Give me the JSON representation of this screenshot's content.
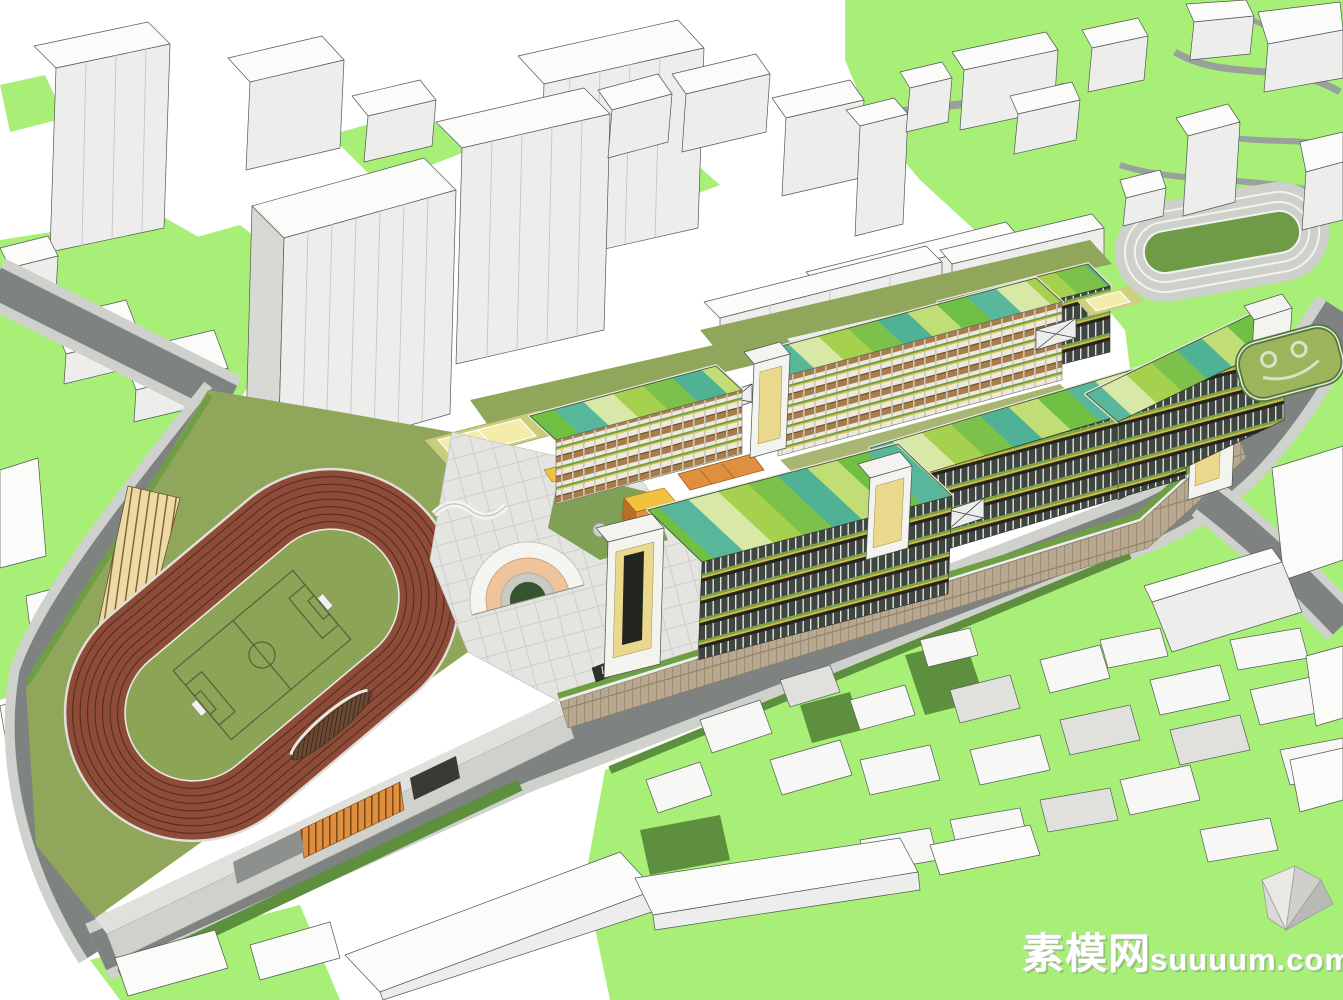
{
  "watermark": {
    "cn": "素模网",
    "en": "suuuum.com",
    "full": "素模网suuuum.com"
  },
  "colors": {
    "sky": "#ffffff",
    "ground_green": "#a7ef76",
    "campus_green": "#90a65a",
    "pitch_green": "#8ca455",
    "dark_green": "#5d8f3e",
    "hedge_green": "#6f9e45",
    "track_red": "#8d4b38",
    "track_line": "#4f2b20",
    "road_dark": "#7e8381",
    "sidewalk": "#d2d4d0",
    "wall_tan": "#b7a88f",
    "roof_teal": "#4fb295",
    "roof_lime": "#c0dd76",
    "roof_green": "#6fc043",
    "facade_dark": "#3f4540",
    "gallery_brown": "#a97d4b",
    "accent_orange": "#df8f3f",
    "accent_yellow": "#f0c23f",
    "stair_yellow": "#ead98c",
    "arch_peach": "#eec49c",
    "plaza_gray": "#e4e5e0",
    "court_yellow": "#f5ecac",
    "bleacher_tan": "#ecd9a4",
    "infield_green": "#6f9b49"
  }
}
